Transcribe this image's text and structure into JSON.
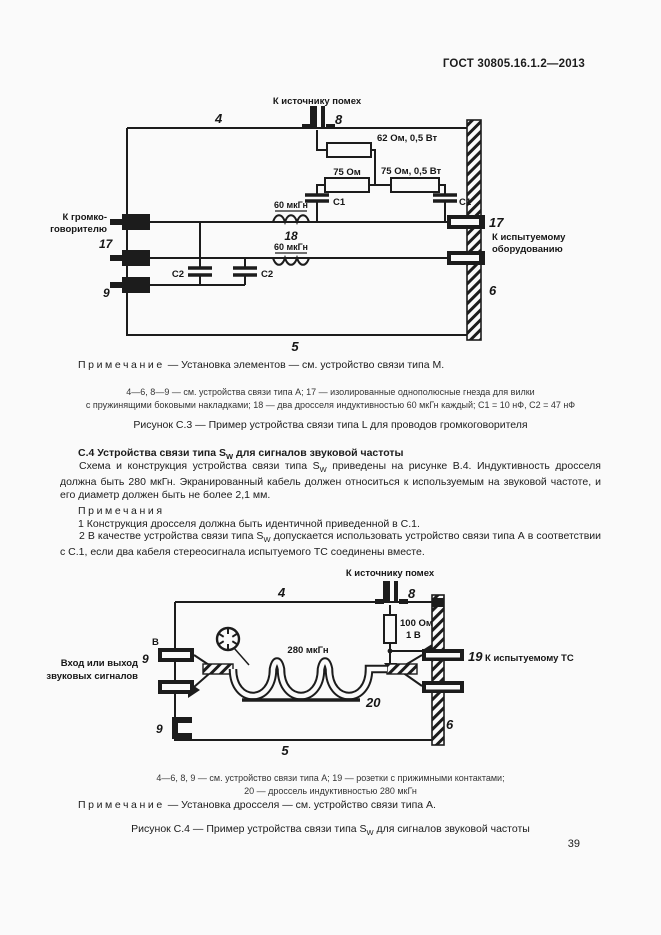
{
  "page": {
    "header": "ГОСТ 30805.16.1.2—2013",
    "page_number": "39"
  },
  "fig_c3": {
    "to_noise_source": "К источнику помех",
    "num4": "4",
    "num8": "8",
    "num5": "5",
    "num6": "6",
    "num9": "9",
    "num17_left": "17",
    "num17_right": "17",
    "num18": "18",
    "r62": "62 Ом, 0,5 Вт",
    "r75": "75 Ом",
    "r75b": "75 Ом, 0,5 Вт",
    "c1_left": "С1",
    "c1_right": "С1",
    "c2_left": "С2",
    "c2_right": "С2",
    "l60_top": "60 мкГн",
    "l60_bottom": "60 мкГн",
    "to_speaker_line1": "К громко-",
    "to_speaker_line2": "говорителю",
    "to_eut_line1": "К испытуемому",
    "to_eut_line2": "оборудованию",
    "note_label": "Примечание",
    "note_text": "—  Установка элементов — см. устройство связи типа М.",
    "legend_line1": "4—6, 8—9 — см. устройства связи типа А; 17 — изолированные однополюсные гнезда для вилки",
    "legend_line2": "с пружинящими боковыми накладками; 18 — два дросселя индуктивностью 60 мкГн каждый; С1 = 10 нФ, С2 = 47 нФ",
    "caption": "Рисунок С.3 — Пример устройства связи типа L для проводов громкоговорителя"
  },
  "section_c4": {
    "heading_pre": "С.4 Устройства связи типа S",
    "heading_sub": "W",
    "heading_post": " для сигналов звуковой частоты",
    "para_pre": "Схема и конструкция устройства связи типа S",
    "para_sub": "W",
    "para_post": " приведены на рисунке В.4. Индуктивность дросселя должна быть 280 мкГн. Экранированный кабель должен относиться к используемым на звуковой частоте, и его диаметр должен быть не более 2,1 мм.",
    "notes_header": "Примечания",
    "note1": "1 Конструкция дросселя должна быть идентичной приведенной в С.1.",
    "note2_pre": "2 В качестве устройства связи типа S",
    "note2_sub": "W",
    "note2_post": " допускается использовать устройство связи типа А в соответствии с С.1, если два кабеля стереосигнала испытуемого ТС соединены вместе."
  },
  "fig_c4": {
    "to_noise_source": "К источнику помех",
    "num4": "4",
    "num8": "8",
    "num5": "5",
    "num6": "6",
    "num9_top": "9",
    "num9_bottom": "9",
    "num19": "19",
    "num20": "20",
    "r100_line1": "100 Ом",
    "r100_line2": "1 В",
    "l280": "280 мкГн",
    "b_label": "В",
    "input_line1": "Вход или выход",
    "input_line2": "звуковых сигналов",
    "to_eut": "К испытуемому ТС",
    "legend_line1": "4—6, 8, 9 — см. устройство связи типа А; 19 — розетки с прижимными контактами;",
    "legend_line2": "20 — дроссель индуктивностью 280 мкГн",
    "note_label": "Примечание",
    "note_text": "—  Установка дросселя — см. устройство связи типа А.",
    "caption_pre": "Рисунок С.4 — Пример устройства связи типа S",
    "caption_sub": "W",
    "caption_post": " для сигналов звуковой частоты"
  }
}
